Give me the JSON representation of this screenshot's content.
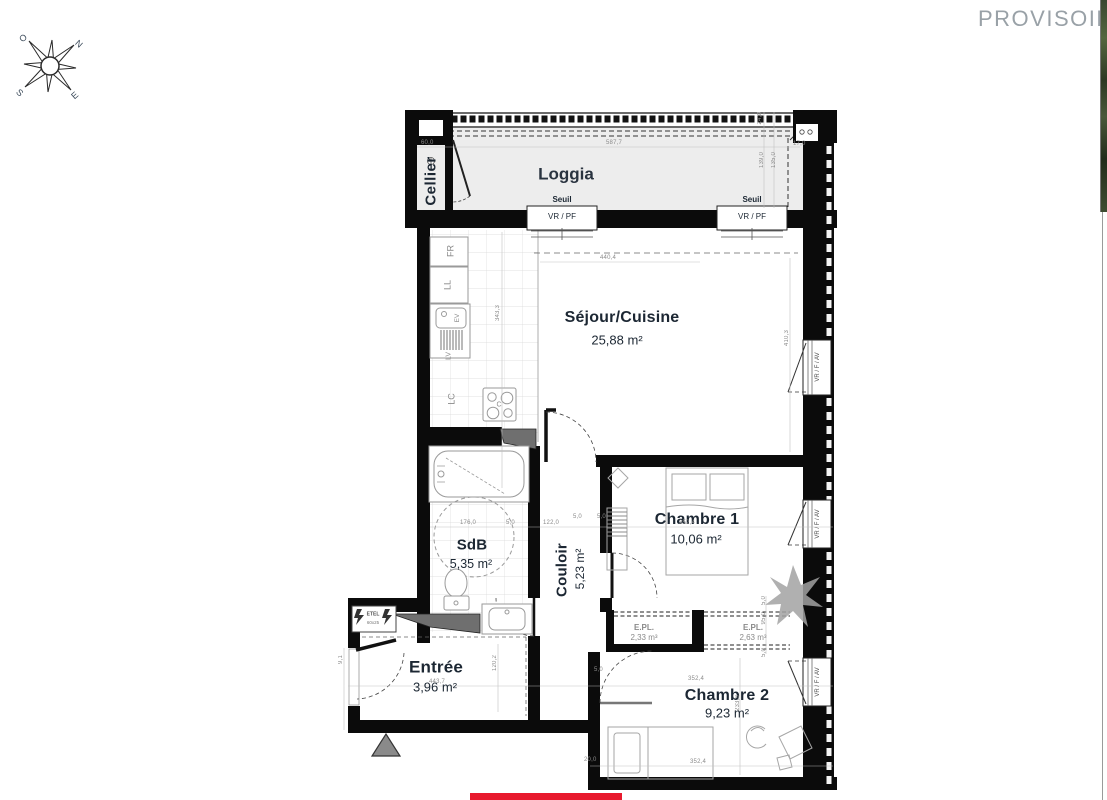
{
  "watermark": {
    "text": "PROVISOIRE"
  },
  "compass": {
    "north": "N",
    "south": "S",
    "east": "E",
    "west": "O"
  },
  "plan": {
    "rooms": {
      "cellier": {
        "name": "Cellier"
      },
      "loggia": {
        "name": "Loggia"
      },
      "sejour": {
        "name": "Séjour/Cuisine",
        "area": "25,88 m²"
      },
      "chambre1": {
        "name": "Chambre 1",
        "area": "10,06 m²"
      },
      "sdb": {
        "name": "SdB",
        "area": "5,35 m²"
      },
      "couloir": {
        "name": "Couloir",
        "area": "5,23 m²"
      },
      "entree": {
        "name": "Entrée",
        "area": "3,96 m²"
      },
      "chambre2": {
        "name": "Chambre 2",
        "area": "9,23 m²"
      },
      "placard1": {
        "name": "E.PL.",
        "area": "2,33 m³"
      },
      "placard2": {
        "name": "E.PL.",
        "area": "2,63 m³"
      }
    },
    "openings": {
      "seuil": "Seuil",
      "vr_pf": "VR / PF",
      "vr_f_av": "VR / F / AV"
    },
    "kitchen": {
      "fr": "FR",
      "ll": "LL",
      "ev": "EV",
      "lv": "LV",
      "lc": "LC",
      "cooktop": "C"
    },
    "electrical": {
      "label": "ETEL",
      "size": "60x25"
    },
    "dimensions": [
      {
        "t": "60,0",
        "x": 421,
        "y": 140
      },
      {
        "t": "587,7",
        "x": 606,
        "y": 140
      },
      {
        "t": "17,0",
        "x": 793,
        "y": 141
      },
      {
        "t": "24,0",
        "x": 757,
        "y": 112,
        "v": true
      },
      {
        "t": "139,0",
        "x": 759,
        "y": 152,
        "v": true
      },
      {
        "t": "135,0",
        "x": 771,
        "y": 152,
        "v": true
      },
      {
        "t": "440,4",
        "x": 600,
        "y": 255
      },
      {
        "t": "343,3",
        "x": 495,
        "y": 305,
        "v": true
      },
      {
        "t": "410,3",
        "x": 784,
        "y": 330,
        "v": true
      },
      {
        "t": "176,0",
        "x": 460,
        "y": 520
      },
      {
        "t": "5,0",
        "x": 506,
        "y": 520
      },
      {
        "t": "122,0",
        "x": 543,
        "y": 520
      },
      {
        "t": "5,0",
        "x": 573,
        "y": 514
      },
      {
        "t": "5,0",
        "x": 597,
        "y": 514
      },
      {
        "t": "352,4",
        "x": 679,
        "y": 520
      },
      {
        "t": "9,1",
        "x": 338,
        "y": 655,
        "v": true
      },
      {
        "t": "443,7",
        "x": 429,
        "y": 679
      },
      {
        "t": "120,2",
        "x": 492,
        "y": 655,
        "v": true
      },
      {
        "t": "5,0",
        "x": 594,
        "y": 667
      },
      {
        "t": "352,4",
        "x": 688,
        "y": 676
      },
      {
        "t": "233,3",
        "x": 735,
        "y": 695,
        "v": true
      },
      {
        "t": "352,4",
        "x": 690,
        "y": 759
      },
      {
        "t": "20,0",
        "x": 584,
        "y": 757
      },
      {
        "t": "5,0",
        "x": 761,
        "y": 596,
        "v": true
      },
      {
        "t": "95,0",
        "x": 761,
        "y": 612,
        "v": true
      },
      {
        "t": "5,0",
        "x": 761,
        "y": 648,
        "v": true
      }
    ]
  },
  "colors": {
    "accent_red": "#e81a2e",
    "wall_black": "#0b0b0b",
    "loggia_gray": "#ededed",
    "label_dark": "#1c2733",
    "dimension_gray": "#8b8b8b"
  }
}
